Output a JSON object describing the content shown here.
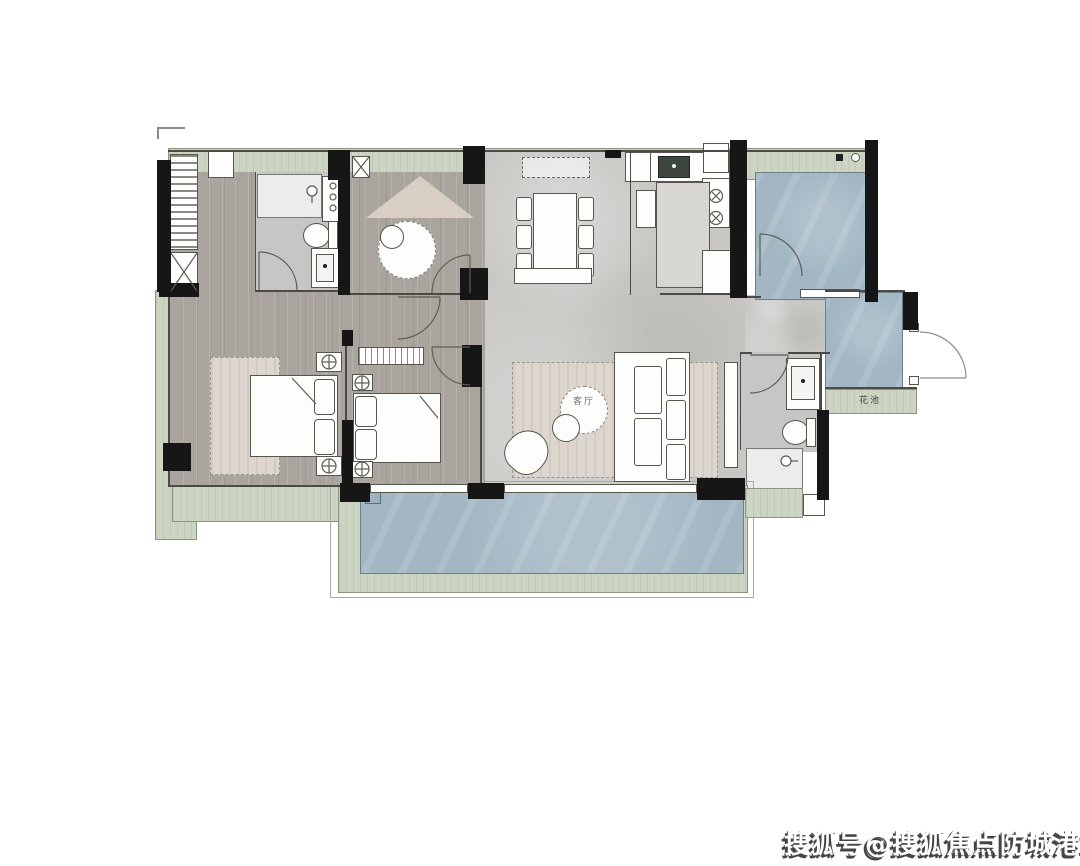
{
  "watermark": {
    "text": "搜狐号@搜狐焦点防城港站"
  },
  "labels": {
    "living_room": "客厅",
    "flower_bed": "花池"
  },
  "colors": {
    "wall": "#161616",
    "wood_floor": "#a9a49d",
    "tile_floor": "#c8c7c4",
    "balcony_tile": "#a2b6c3",
    "green_band": "#ccd5c2",
    "bath_floor": "#c6c6c5",
    "rug": "#ddd6ce",
    "tent": "#d9cec4"
  }
}
